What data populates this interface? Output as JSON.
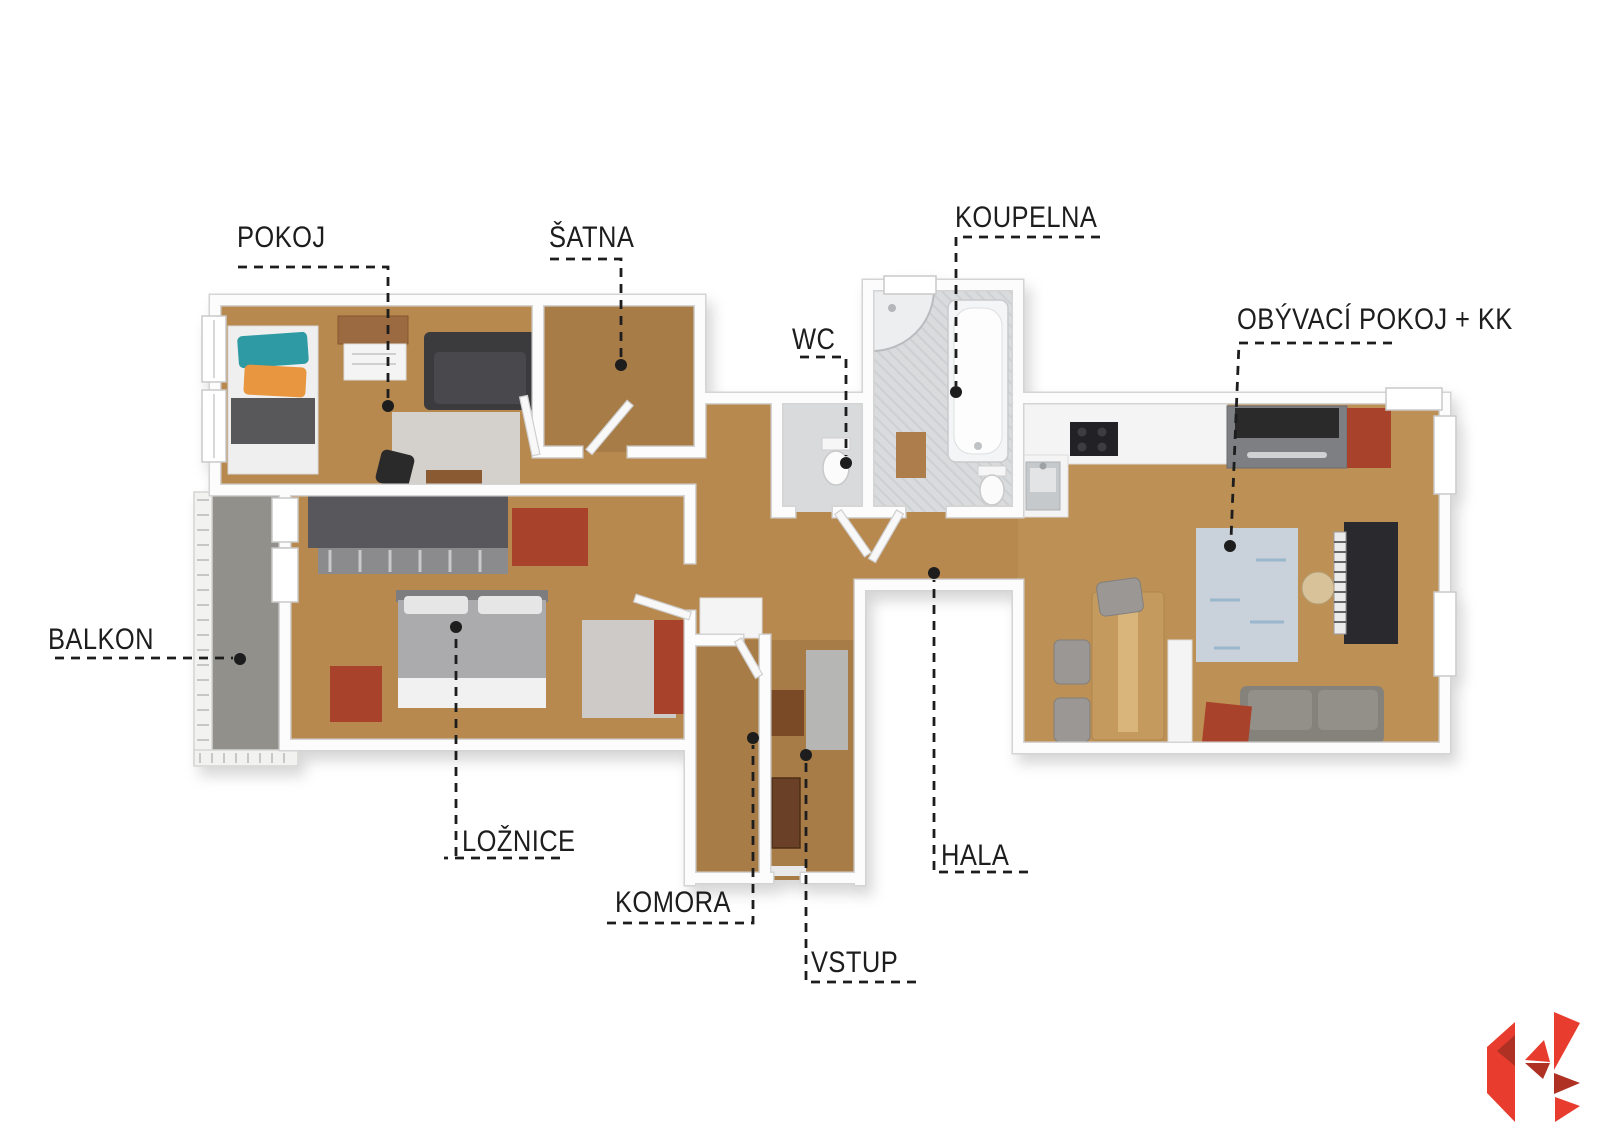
{
  "floorplan": {
    "labels": {
      "pokoj": "POKOJ",
      "satna": "ŠATNA",
      "koupelna": "KOUPELNA",
      "wc": "WC",
      "obyvaci_pokoj": "OBÝVACÍ POKOJ + KK",
      "balkon": "BALKON",
      "loznice": "LOŽNICE",
      "komora": "KOMORA",
      "vstup": "VSTUP",
      "hala": "HALA"
    },
    "colors": {
      "wood_floor": "#b8894f",
      "wood_floor_dark": "#a77c47",
      "wood_floor_light": "#bd9156",
      "tile_floor": "#d8dadc",
      "balcony_floor": "#92908b",
      "wall": "#fcfcfc",
      "wall_outline": "#d4d4d4",
      "label_text": "#1d1d1d",
      "leader_line": "#1d1d1d",
      "furniture_red": "#a9432b",
      "furniture_dark": "#3a3a3c",
      "accent_teal": "#2f9aa3",
      "accent_orange": "#e8963f",
      "rug_blue": "#c9d2da",
      "logo_red": "#e73c2e",
      "logo_dark_red": "#ae3124"
    }
  },
  "branding": {
    "logo_icon": "k-triangles-logo"
  }
}
